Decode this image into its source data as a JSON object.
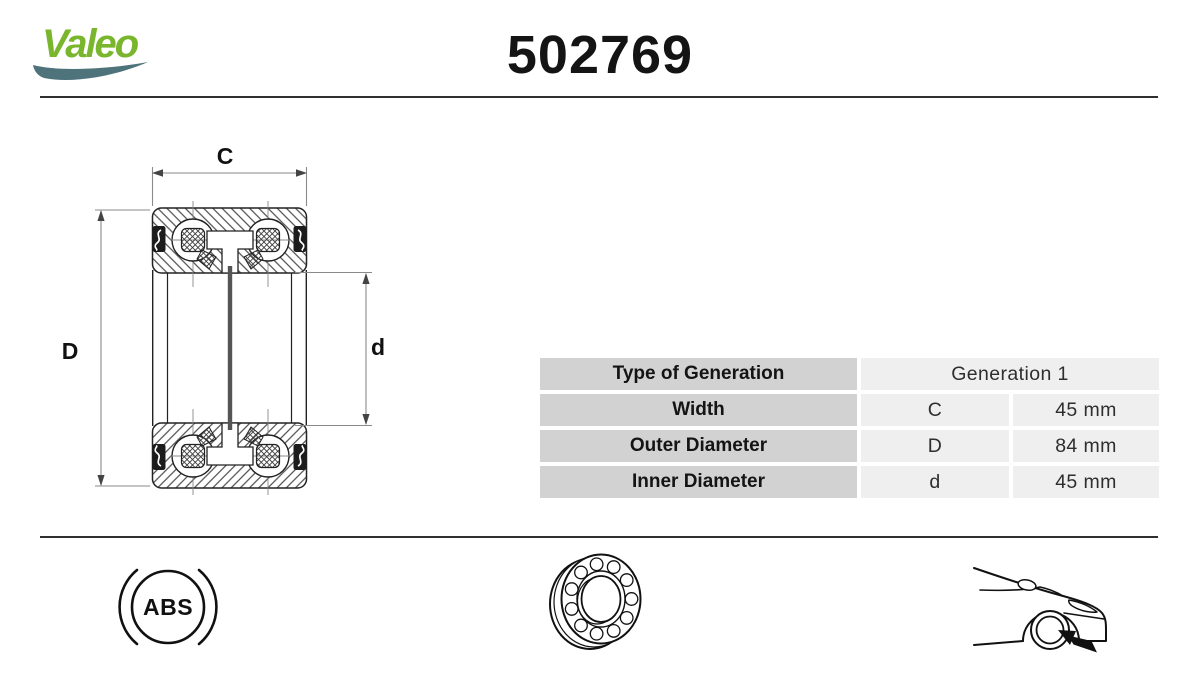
{
  "header": {
    "brand": "Valeo",
    "part_number": "502769"
  },
  "diagram": {
    "width_label": "C",
    "outer_diameter_label": "D",
    "inner_diameter_label": "d"
  },
  "table": {
    "generation": {
      "label": "Type of Generation",
      "value": "Generation 1"
    },
    "rows": [
      {
        "label": "Width",
        "symbol": "C",
        "value": "45 mm"
      },
      {
        "label": "Outer Diameter",
        "symbol": "D",
        "value": "84 mm"
      },
      {
        "label": "Inner Diameter",
        "symbol": "d",
        "value": "45 mm"
      }
    ]
  },
  "footer": {
    "abs_label": "ABS",
    "icons": [
      "abs-badge-icon",
      "wheel-bearing-icon",
      "car-front-wheel-location-icon"
    ]
  },
  "colors": {
    "brand_green": "#7ab62d",
    "swoosh_teal": "#4f737b",
    "table_label_bg": "#d2d2d2",
    "table_value_bg": "#efefef",
    "rule_color": "#2f2f2f",
    "ink": "#141414"
  }
}
